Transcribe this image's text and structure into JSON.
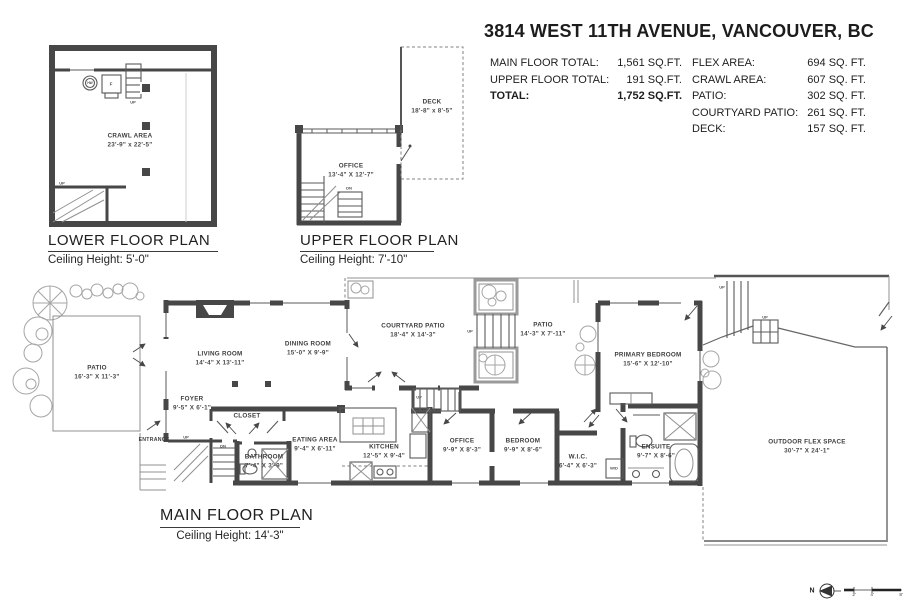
{
  "header": {
    "title": "3814 WEST 11TH AVENUE, VANCOUVER, BC",
    "totals": [
      {
        "label": "MAIN FLOOR TOTAL:",
        "value": "1,561 SQ.FT."
      },
      {
        "label": "UPPER FLOOR TOTAL:",
        "value": "191 SQ.FT."
      },
      {
        "label": "TOTAL:",
        "value": "1,752 SQ.FT."
      }
    ],
    "areas": [
      {
        "label": "FLEX AREA:",
        "value": "694 SQ. FT."
      },
      {
        "label": "CRAWL AREA:",
        "value": "607 SQ. FT."
      },
      {
        "label": "PATIO:",
        "value": "302 SQ. FT."
      },
      {
        "label": "COURTYARD PATIO:",
        "value": "261 SQ. FT."
      },
      {
        "label": "DECK:",
        "value": "157 SQ. FT."
      }
    ]
  },
  "plans": {
    "lower": {
      "title": "LOWER FLOOR PLAN",
      "ceiling": "Ceiling Height: 5'-0\"",
      "rooms": [
        {
          "name": "CRAWL AREA",
          "dims": "23'-9\" x 22'-5\""
        }
      ]
    },
    "upper": {
      "title": "UPPER FLOOR PLAN",
      "ceiling": "Ceiling Height: 7'-10\"",
      "rooms": [
        {
          "name": "OFFICE",
          "dims": "13'-4\" X 12'-7\""
        },
        {
          "name": "DECK",
          "dims": "18'-8\" x 8'-5\""
        }
      ]
    },
    "main": {
      "title": "MAIN FLOOR PLAN",
      "ceiling": "Ceiling Height: 14'-3\"",
      "rooms": [
        {
          "name": "PATIO",
          "dims": "16'-3\" X 11'-3\""
        },
        {
          "name": "LIVING ROOM",
          "dims": "14'-4\" X 13'-11\""
        },
        {
          "name": "DINING ROOM",
          "dims": "15'-0\" X 9'-9\""
        },
        {
          "name": "COURTYARD PATIO",
          "dims": "18'-4\" X 14'-3\""
        },
        {
          "name": "PATIO",
          "dims": "14'-3\" X 7'-11\""
        },
        {
          "name": "PRIMARY BEDROOM",
          "dims": "15'-6\" X 12'-10\""
        },
        {
          "name": "FOYER",
          "dims": "9'-5\" X 6'-1\""
        },
        {
          "name": "CLOSET",
          "dims": ""
        },
        {
          "name": "ENTRANCE",
          "dims": ""
        },
        {
          "name": "BATHROOM",
          "dims": "7'-4\" X 3'-9\""
        },
        {
          "name": "EATING AREA",
          "dims": "9'-4\" X 6'-11\""
        },
        {
          "name": "KITCHEN",
          "dims": "12'-5\" X 9'-4\""
        },
        {
          "name": "OFFICE",
          "dims": "9'-9\" X 8'-3\""
        },
        {
          "name": "BEDROOM",
          "dims": "9'-9\" X 8'-6\""
        },
        {
          "name": "W.I.C.",
          "dims": "6'-4\" X 6'-3\""
        },
        {
          "name": "ENSUITE",
          "dims": "9'-7\" X 8'-6\""
        },
        {
          "name": "OUTDOOR FLEX SPACE",
          "dims": "30'-7\" X 24'-1\""
        }
      ]
    }
  },
  "glyphs": {
    "up": "UP",
    "dn": "DN",
    "hw": "HW",
    "f": "F",
    "wd": "W/D",
    "north": "N"
  },
  "compass": {
    "scale_ticks": [
      "2'",
      "4'",
      "8'"
    ]
  },
  "colors": {
    "wall": "#474747",
    "text": "#3d3d3d",
    "thin_line": "#909090"
  }
}
